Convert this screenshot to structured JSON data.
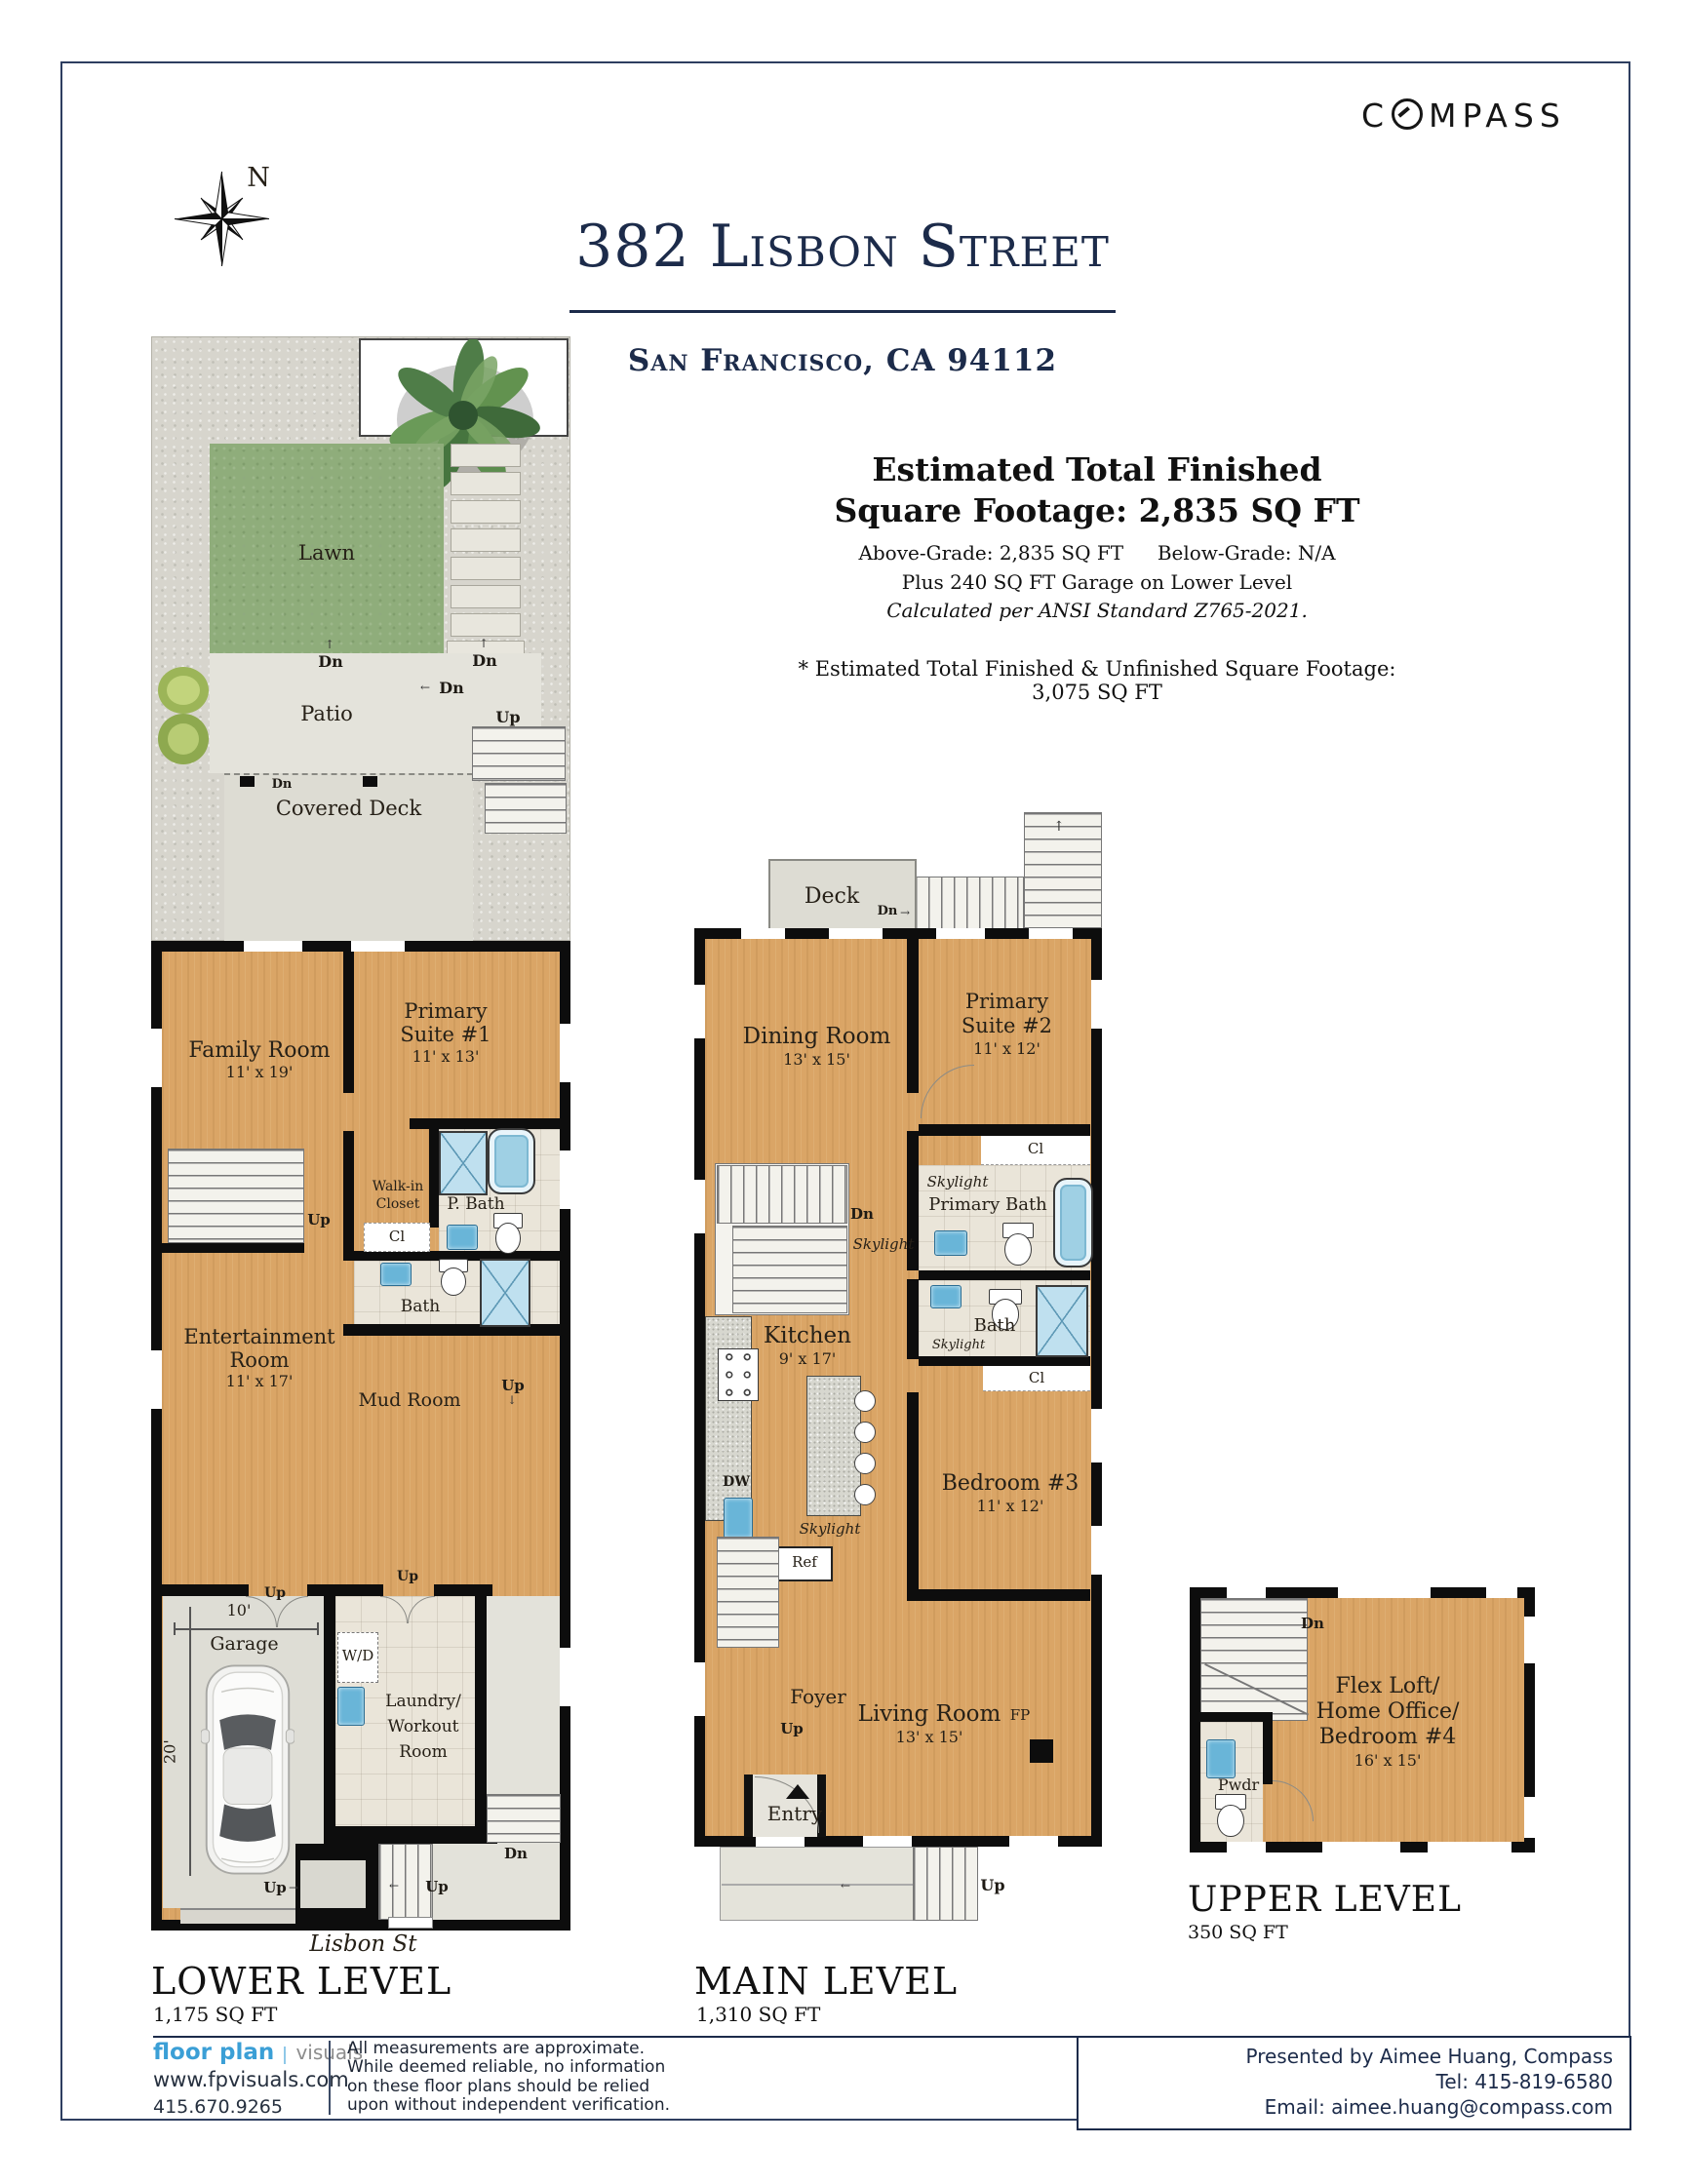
{
  "colors": {
    "navy": "#1C2B4A",
    "wood": "#DAA566",
    "lawn_green": "#8FAD7B",
    "wall_black": "#0D0D0D",
    "fixture_blue": "#69B5D8",
    "logo_blue": "#3B9FD6"
  },
  "icons": {
    "up_arrow": "↑",
    "down_arrow": "↓",
    "left_arrow": "←",
    "right_arrow": "→"
  },
  "header": {
    "address": "382 Lisbon Street",
    "city": "San Francisco, CA 94112",
    "brand": "COMPASS",
    "north": "N"
  },
  "summary": {
    "line1": "Estimated Total Finished",
    "line2": "Square Footage: 2,835 SQ FT",
    "above_grade": "Above-Grade: 2,835 SQ FT",
    "below_grade": "Below-Grade: N/A",
    "garage_note": "Plus 240 SQ FT Garage on Lower Level",
    "ansi_note": "Calculated per ANSI Standard Z765-2021.",
    "footnote": "* Estimated Total Finished & Unfinished Square Footage: 3,075 SQ FT"
  },
  "markers": {
    "up": "Up",
    "dn": "Dn"
  },
  "lower": {
    "title": "LOWER LEVEL",
    "sqft": "1,175 SQ FT",
    "street": "Lisbon St",
    "lawn": "Lawn",
    "patio": "Patio",
    "covered_deck": "Covered Deck",
    "family_name": "Family Room",
    "family_dims": "11' x 19'",
    "suite1_line1": "Primary",
    "suite1_line2": "Suite #1",
    "suite1_dims": "11' x 13'",
    "walkin_line1": "Walk-in",
    "walkin_line2": "Closet",
    "pbath": "P. Bath",
    "cl": "Cl",
    "bath": "Bath",
    "ent_line1": "Entertainment",
    "ent_line2": "Room",
    "ent_dims": "11' x 17'",
    "mud": "Mud Room",
    "garage": "Garage",
    "garage_width": "10'",
    "garage_depth": "20'",
    "wd": "W/D",
    "laundry_line1": "Laundry/",
    "laundry_line2": "Workout",
    "laundry_line3": "Room"
  },
  "main": {
    "title": "MAIN LEVEL",
    "sqft": "1,310 SQ FT",
    "deck": "Deck",
    "dining_name": "Dining Room",
    "dining_dims": "13' x 15'",
    "suite2_line1": "Primary",
    "suite2_line2": "Suite #2",
    "suite2_dims": "11' x 12'",
    "cl": "Cl",
    "skylight": "Skylight",
    "primary_bath": "Primary Bath",
    "bath": "Bath",
    "kitchen_name": "Kitchen",
    "kitchen_dims": "9' x 17'",
    "dw": "DW",
    "ref": "Ref",
    "bed3_name": "Bedroom #3",
    "bed3_dims": "11' x 12'",
    "foyer": "Foyer",
    "living_name": "Living Room",
    "living_dims": "13' x 15'",
    "fp": "FP",
    "entry": "Entry"
  },
  "upper": {
    "title": "UPPER LEVEL",
    "sqft": "350 SQ FT",
    "flex_line1": "Flex Loft/",
    "flex_line2": "Home Office/",
    "flex_line3": "Bedroom #4",
    "flex_dims": "16' x 15'",
    "pwdr": "Pwdr"
  },
  "footer": {
    "logo_primary": "floor plan",
    "logo_secondary": "visuals",
    "url": "www.fpvisuals.com",
    "phone": "415.670.9265",
    "disclaimer_line1": "All measurements are approximate.",
    "disclaimer_line2": "While deemed reliable, no information",
    "disclaimer_line3": "on these floor plans should be relied",
    "disclaimer_line4": "upon without independent verification.",
    "presented_by": "Presented by Aimee Huang, Compass",
    "tel": "Tel: 415-819-6580",
    "email": "Email: aimee.huang@compass.com"
  }
}
